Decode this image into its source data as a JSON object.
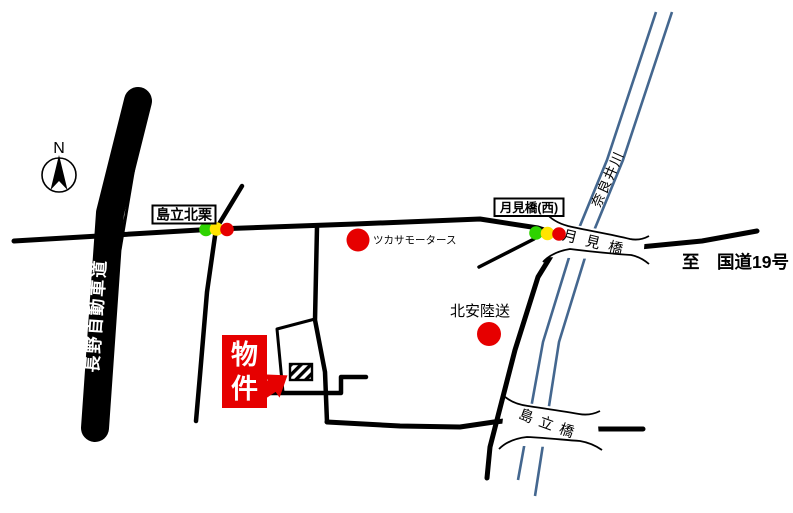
{
  "map": {
    "compass": {
      "label": "N"
    },
    "expressway": {
      "label": "長野自動車道"
    },
    "river": {
      "label": "奈良井川"
    },
    "intersections": [
      {
        "label": "島立北栗",
        "signal": "green-yellow-red"
      },
      {
        "label": "月見橋(西)",
        "signal": "green-yellow-red"
      }
    ],
    "bridges": [
      {
        "label": "月見橋"
      },
      {
        "label": "島立橋"
      }
    ],
    "pois": [
      {
        "label": "ツカサモータース",
        "marker": "red-circle"
      },
      {
        "label": "北安陸送",
        "marker": "red-circle"
      }
    ],
    "property": {
      "label": "物件",
      "chars": [
        "物",
        "件"
      ],
      "marker": "hatched-box"
    },
    "destination": {
      "label": "至　国道19号"
    },
    "colors": {
      "road": "#000000",
      "river": "#44678f",
      "red": "#e60000",
      "signal_green": "#2ed300",
      "signal_yellow": "#ffe400",
      "signal_red": "#e60000"
    }
  }
}
